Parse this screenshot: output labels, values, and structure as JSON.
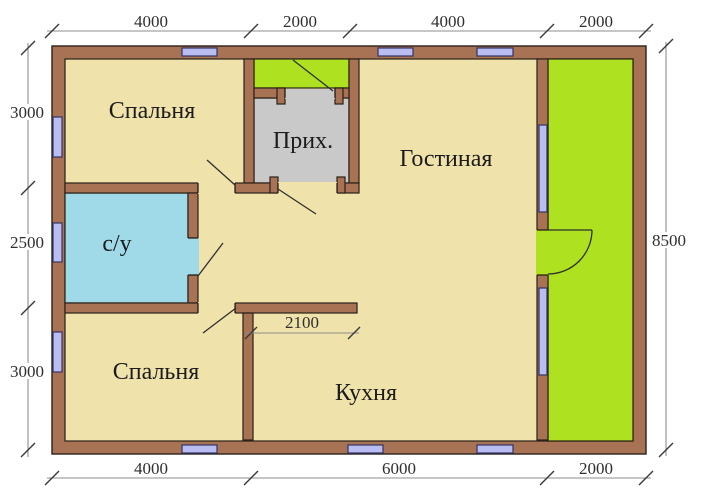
{
  "drawing": {
    "type": "floor-plan",
    "rooms": [
      {
        "id": "bedroom-top",
        "label": "Спальня"
      },
      {
        "id": "entry-hall",
        "label": "Прих."
      },
      {
        "id": "living-room",
        "label": "Гостиная"
      },
      {
        "id": "bathroom",
        "label": "с/у"
      },
      {
        "id": "bedroom-bottom",
        "label": "Спальня"
      },
      {
        "id": "kitchen",
        "label": "Кухня"
      }
    ],
    "dimensions": {
      "top": [
        "4000",
        "2000",
        "4000",
        "2000"
      ],
      "bottom": [
        "4000",
        "6000",
        "2000"
      ],
      "left": [
        "3000",
        "2500",
        "3000"
      ],
      "right": [
        "8500"
      ],
      "interior": [
        "2100"
      ]
    },
    "colors": {
      "wall_fill": "#A87254",
      "outline": "#2a2018",
      "floor_tan": "#EFE2AB",
      "porch_green": "#AEE11F",
      "hall_gray": "#C9C9C9",
      "bath_blue": "#A0DAE9",
      "window_fill": "#B9BDF2",
      "window_border": "#333366",
      "dim_line": "#8c8c8c",
      "dim_tick": "#3a3a3a"
    }
  }
}
